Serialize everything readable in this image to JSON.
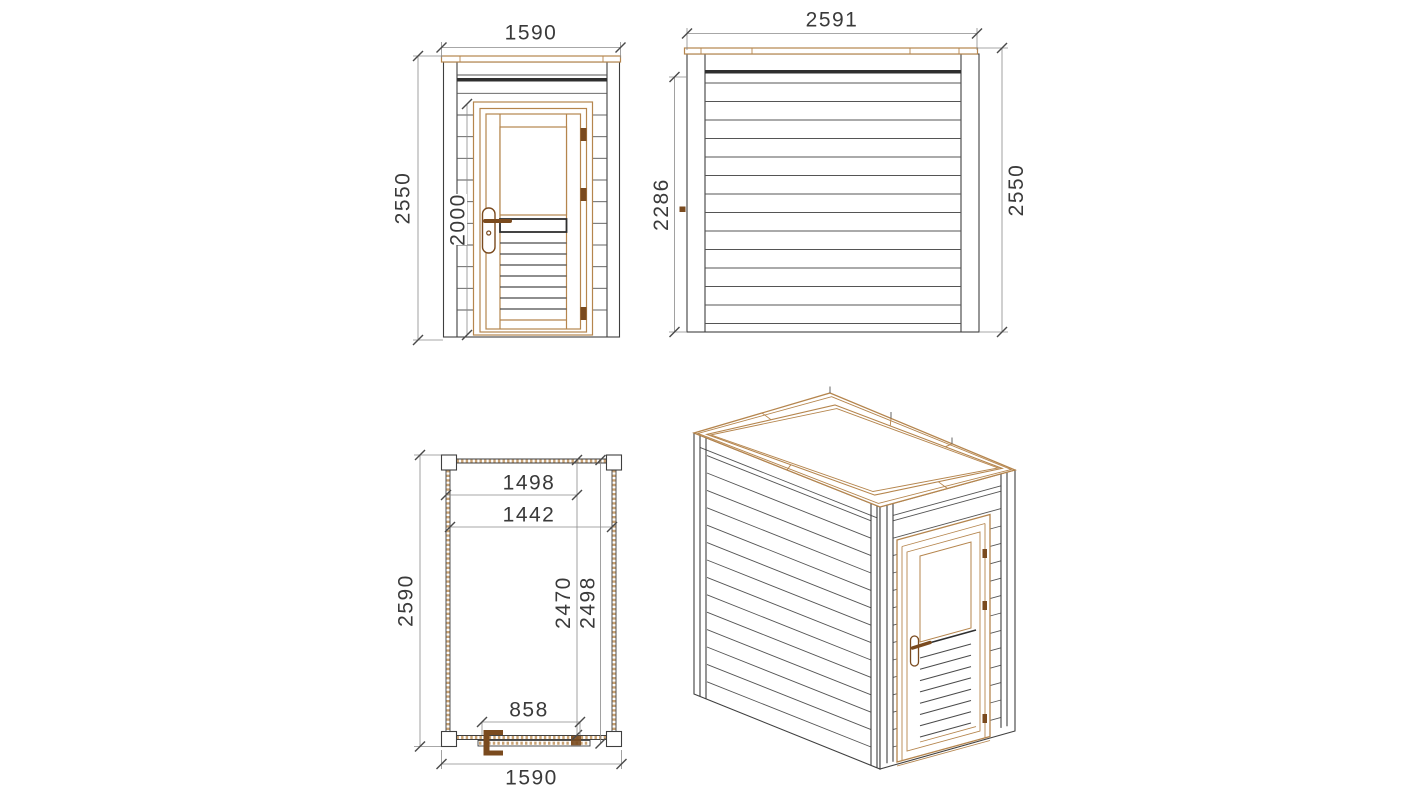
{
  "drawing": {
    "subject": "flat-roof timber cabin technical drawing, four views",
    "views": {
      "front_elevation": {
        "dims": {
          "width": "1590",
          "height": "2550",
          "door_height": "2000"
        }
      },
      "side_elevation": {
        "dims": {
          "width": "2591",
          "side_height": "2286",
          "height": "2550"
        }
      },
      "floor_plan": {
        "dims": {
          "depth": "2590",
          "width": "1590",
          "top_inner_width": "1498",
          "inner_width": "1442",
          "inner_depth": "2470",
          "outer_depth": "2498",
          "door_width": "858"
        }
      }
    },
    "colors": {
      "background": "#ffffff",
      "outline": "#3f3f3f",
      "siding_line": "#555555",
      "dark_band": "#2f2f2f",
      "wood_trim": "#b5854d",
      "wood_hatch": "#c9a273",
      "hardware_brown": "#7a4a1e",
      "dimension_line": "#8a8a8a",
      "dimension_text": "#3a3a3a"
    }
  }
}
